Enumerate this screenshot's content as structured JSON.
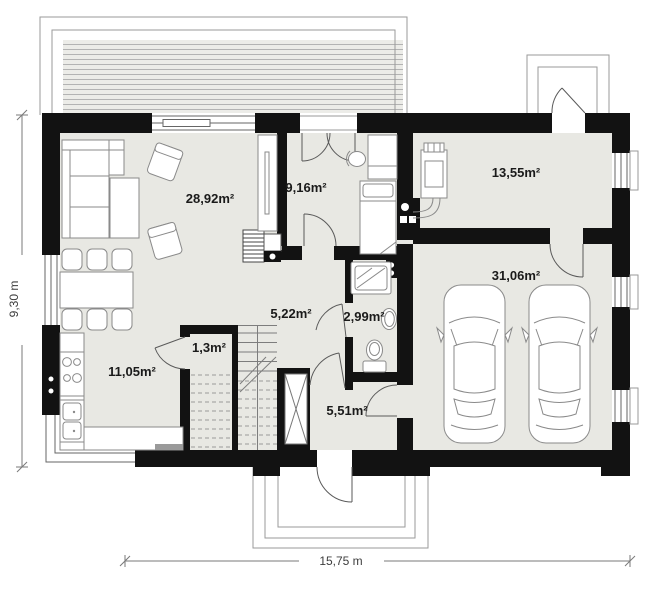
{
  "plan": {
    "type": "floor-plan",
    "rooms": [
      {
        "id": "living-room",
        "area": "28,92m²"
      },
      {
        "id": "room",
        "area": "9,16m²"
      },
      {
        "id": "utility-room",
        "area": "13,55m²"
      },
      {
        "id": "hall",
        "area": "5,22m²"
      },
      {
        "id": "bathroom",
        "area": "2,99m²"
      },
      {
        "id": "garage",
        "area": "31,06m²"
      },
      {
        "id": "pantry",
        "area": "1,3m²"
      },
      {
        "id": "kitchen",
        "area": "11,05m²"
      },
      {
        "id": "vestibule",
        "area": "5,51m²"
      }
    ],
    "dimensions": {
      "overall_width": "15,75 m",
      "overall_height": "9,30 m"
    },
    "colors": {
      "wall": "#121212",
      "floor": "#e8e8e3",
      "terrace_deck": "#ecece8",
      "terrace_stripe": "#b3b3b3",
      "label_text": "#1a1a1a",
      "dimension_text": "#3d3d3d"
    }
  }
}
